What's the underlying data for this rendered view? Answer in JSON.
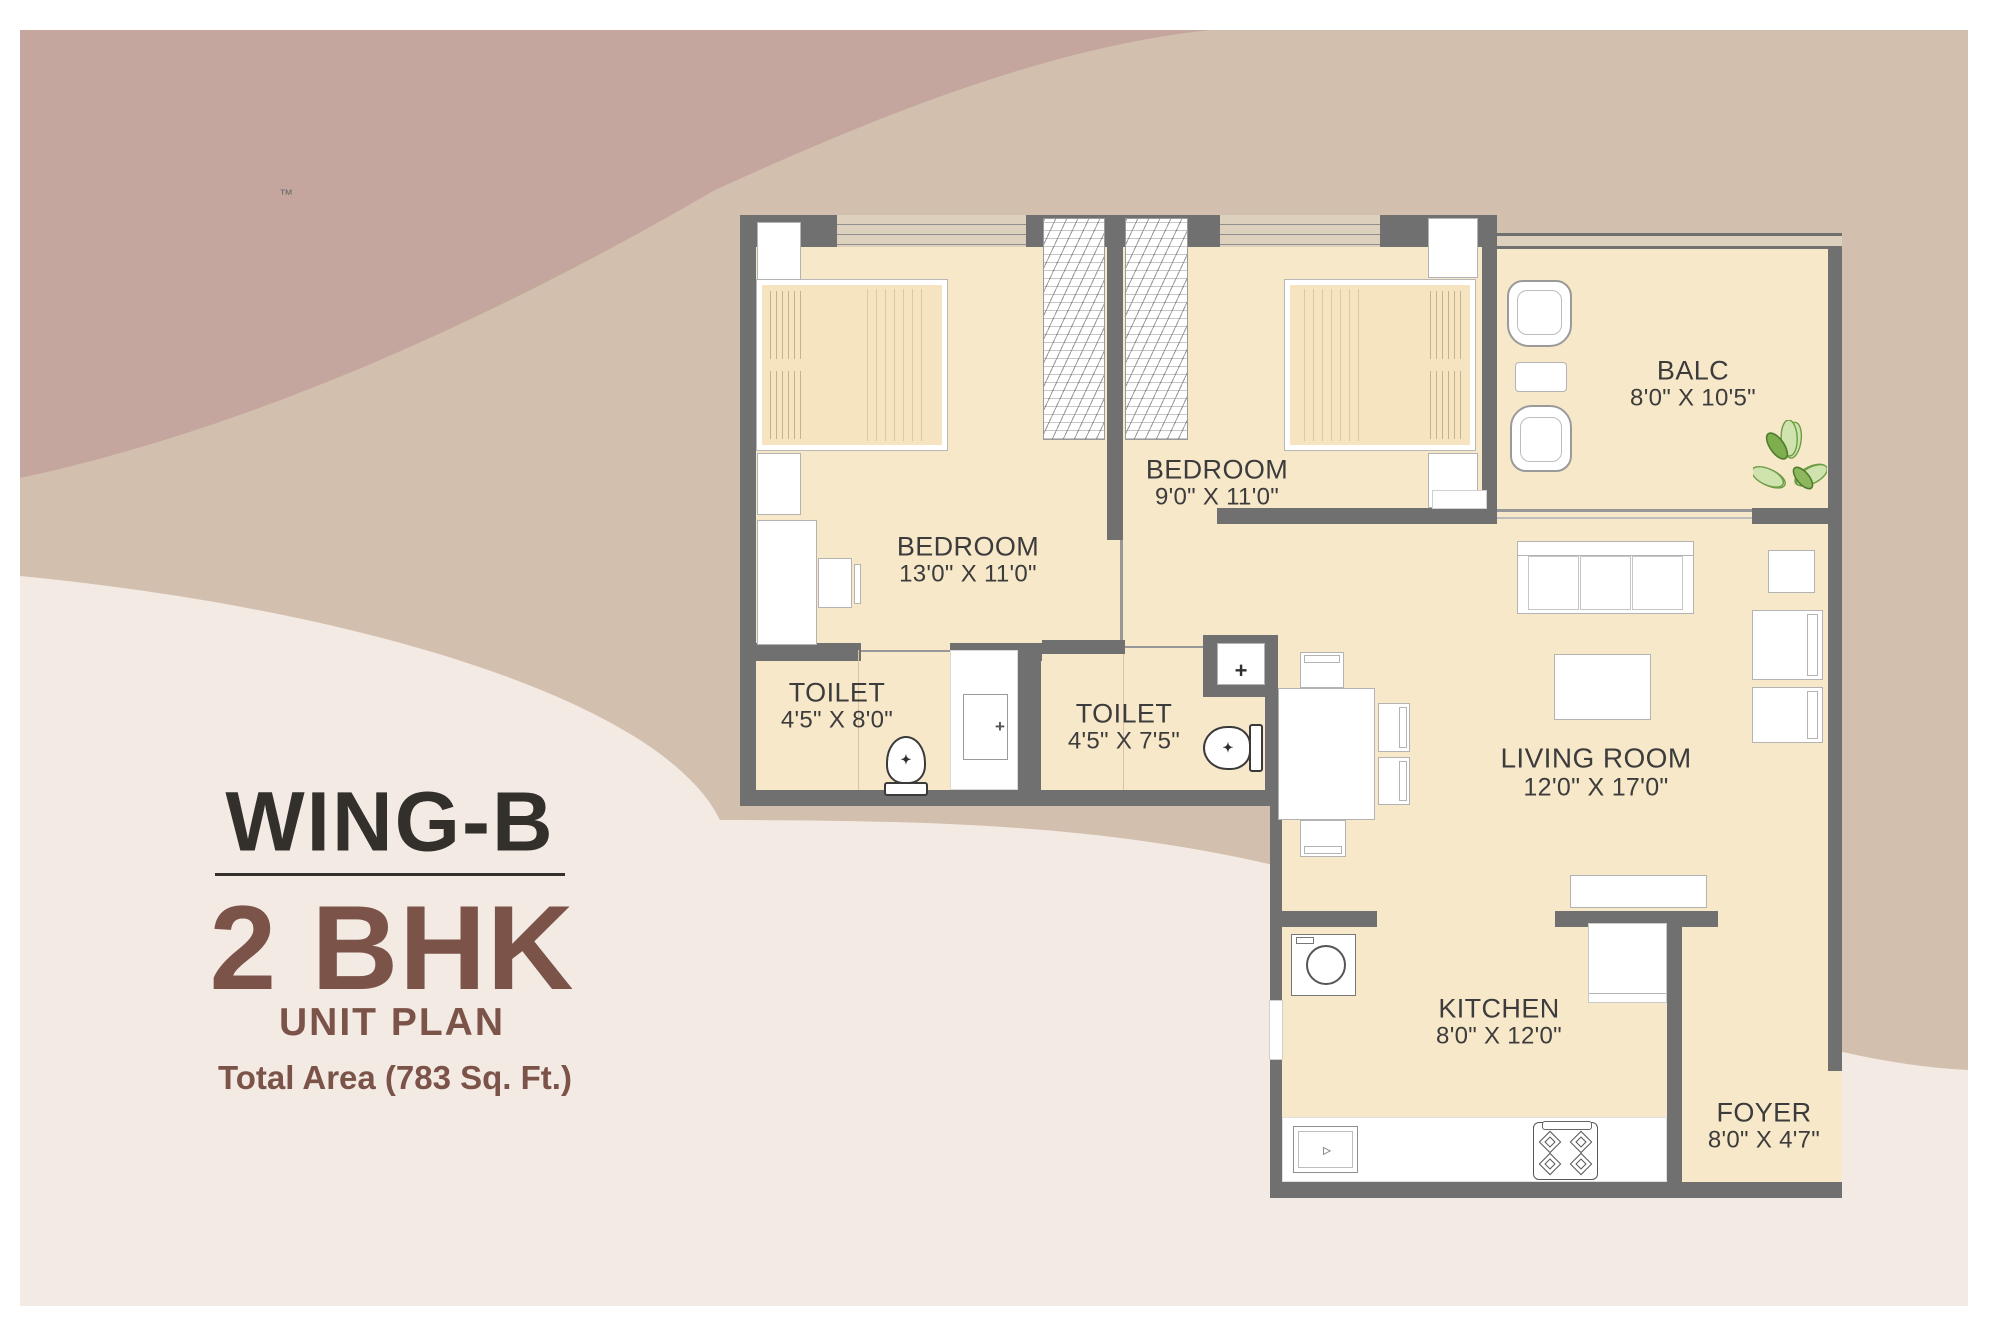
{
  "title_block": {
    "wing": "WING-B",
    "unit_type": "2 BHK",
    "unit_plan_label": "UNIT PLAN",
    "total_area": "Total Area (783 Sq. Ft.)",
    "trademark": "™"
  },
  "rooms": {
    "bedroom1": {
      "name": "BEDROOM",
      "dims": "13'0\" X 11'0\""
    },
    "bedroom2": {
      "name": "BEDROOM",
      "dims": "9'0\" X 11'0\""
    },
    "balcony": {
      "name": "BALC",
      "dims": "8'0\" X 10'5\""
    },
    "living": {
      "name": "LIVING ROOM",
      "dims": "12'0\" X 17'0\""
    },
    "toilet1": {
      "name": "TOILET",
      "dims": "4'5\" X 8'0\""
    },
    "toilet2": {
      "name": "TOILET",
      "dims": "4'5\" X 7'5\""
    },
    "kitchen": {
      "name": "KITCHEN",
      "dims": "8'0\" X 12'0\""
    },
    "foyer": {
      "name": "FOYER",
      "dims": "8'0\" X 4'7\""
    }
  },
  "colors": {
    "background_mauve": "#c5a69e",
    "background_tan": "#d2bfae",
    "background_cream": "#f3eae3",
    "floor": "#f7e8c9",
    "wall": "#707070",
    "accent_brown": "#7b5348",
    "title_dark": "#33302c",
    "plant_green": "#6d9c44"
  }
}
